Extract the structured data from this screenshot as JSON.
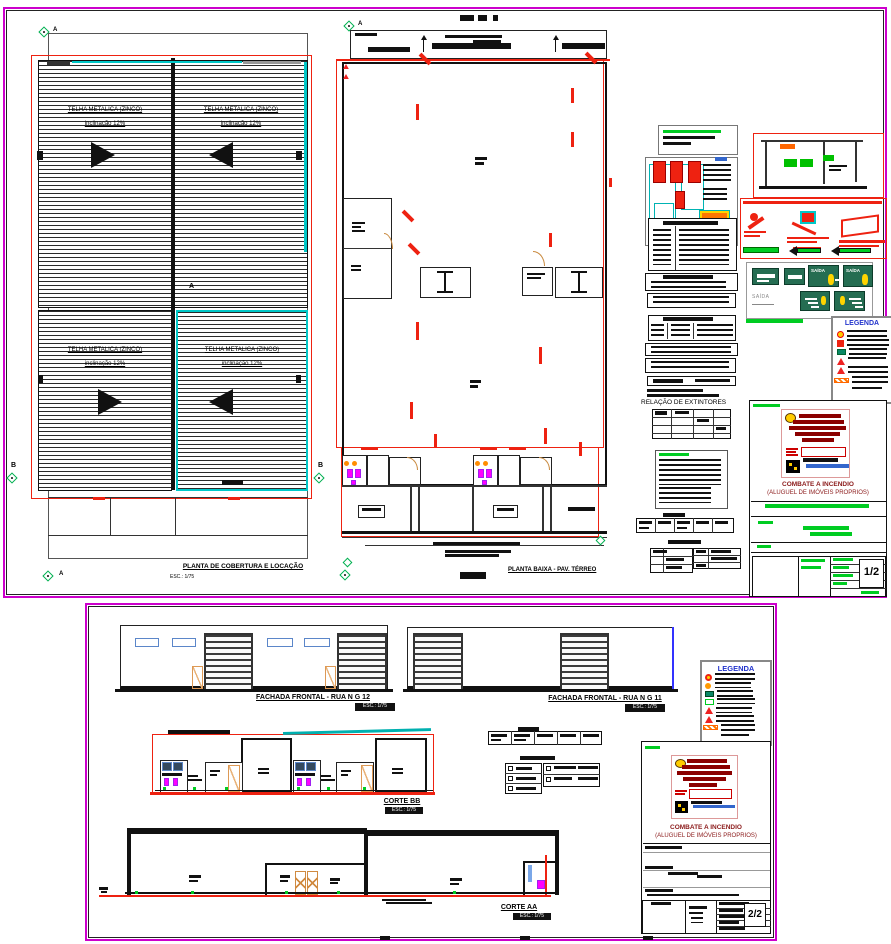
{
  "colors": {
    "sheet_border": "#cc00cc",
    "red_outline": "#ee2211",
    "cyan_highlight": "#00c8c8",
    "grid_marker_green": "#00b050",
    "field_text_green": "#00cc22",
    "exit_sign_green": "#256d52",
    "legend_title_blue": "#2233cc",
    "project_title_red": "#8b1a1a",
    "door_orange": "#e8b075",
    "fixture_magenta": "#ff00ff"
  },
  "sheet1": {
    "roof_plan": {
      "title": "PLANTA DE COBERTURA E LOCAÇÃO",
      "scale": "ESC.: 1/75",
      "panel_label_line1": "TELHA  METALICA (ZINCO)",
      "panel_label_line2": "inclinação 12%",
      "grid_a_top": "A",
      "grid_a_bottom": "A",
      "grid_b_left": "B",
      "grid_b_right": "B",
      "section_marker": "A"
    },
    "floor_plan": {
      "title": "PLANTA BAIXA - PAV. TÉRREO",
      "grid_a_top": "A"
    },
    "extinguisher_schedule_title": "RELAÇÃO DE EXTINTORES",
    "exit_sign_label": "SAÍDA",
    "legend_title": "LEGENDA",
    "title_block": {
      "project_line1": "COMBATE A INCENDIO",
      "project_line2": "(ALUGUEL DE IMÓVEIS PROPRIOS)",
      "sheet_number": "1/2"
    },
    "icons": [
      "fire-extinguisher-marker",
      "hydrant-detail",
      "exit-sign",
      "stair-exit-sign",
      "legend-pin-icon",
      "alarm-triangle-icon",
      "hose-hatch-icon"
    ]
  },
  "sheet2": {
    "facade_12_title": "FACHADA FRONTAL - RUA N G 12",
    "facade_12_scale": "ESC.: 1/75",
    "facade_11_title": "FACHADA FRONTAL - RUA N G 11",
    "facade_11_scale": "ESC.: 1/75",
    "section_bb_title": "CORTE BB",
    "section_bb_scale": "ESC.: 1/75",
    "section_aa_title": "CORTE AA",
    "section_aa_scale": "ESC.: 1/75",
    "legend_title": "LEGENDA",
    "title_block": {
      "project_line1": "COMBATE A INCENDIO",
      "project_line2": "(ALUGUEL DE IMÓVEIS PROPRIOS)",
      "sheet_number": "2/2"
    }
  }
}
